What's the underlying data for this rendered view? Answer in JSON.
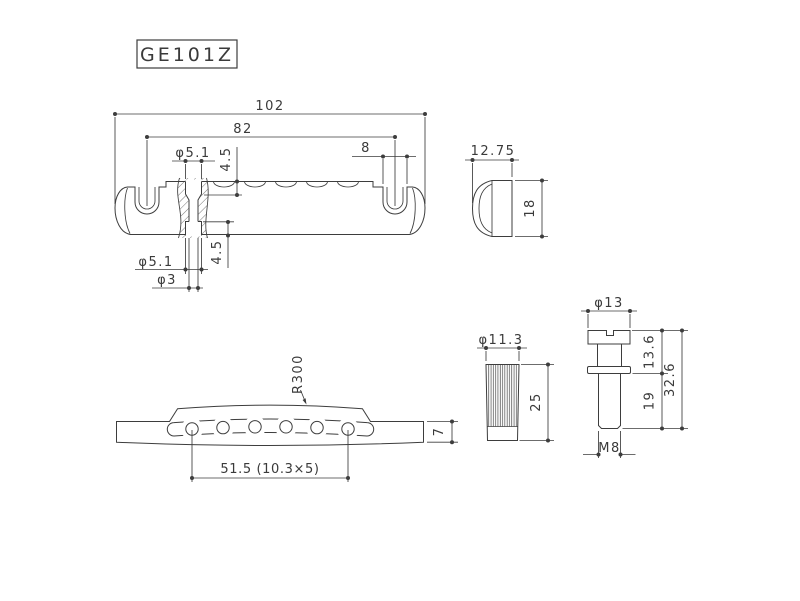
{
  "part_label": "GE101Z",
  "side_view": {
    "overall_length": "102",
    "stud_spacing": "82",
    "notch_width": "8",
    "string_hole_top": "φ5.1",
    "recess_depth_top": "4.5",
    "recess_depth_bottom": "4.5",
    "counterbore_dia": "φ5.1",
    "exit_hole_dia": "φ3"
  },
  "end_view": {
    "width": "12.75",
    "height": "18"
  },
  "front_view": {
    "top_radius": "R300",
    "end_thickness": "7",
    "string_spacing": "51.5 (10.3×5)"
  },
  "bushing": {
    "diameter": "φ11.3",
    "length": "25"
  },
  "stud": {
    "head_diameter": "φ13",
    "upper_length": "13.6",
    "thread_length": "19",
    "overall_length": "32.6",
    "thread_size": "M8"
  },
  "colors": {
    "line": "#3d3d3d",
    "background": "#ffffff"
  }
}
